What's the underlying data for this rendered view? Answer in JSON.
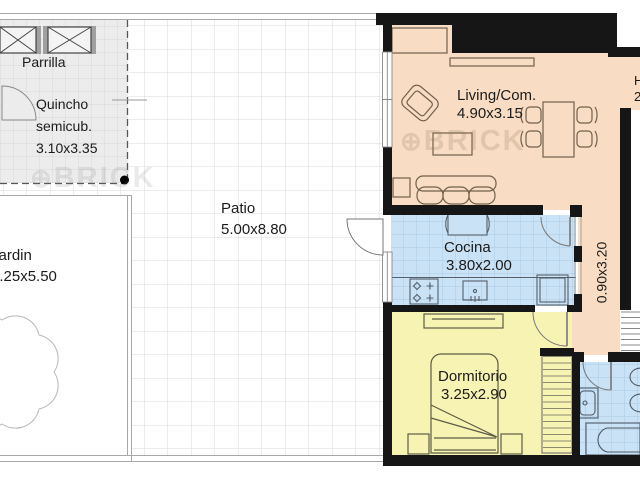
{
  "watermark": {
    "icon": "⊕",
    "text": "BRICK"
  },
  "rooms": {
    "parrilla": {
      "label": "Parrilla"
    },
    "quincho": {
      "line1": "Quincho",
      "line2": "semicub.",
      "dims": "3.10x3.35"
    },
    "patio": {
      "label": "Patio",
      "dims": "5.00x8.80"
    },
    "jardin": {
      "label": "Jardin",
      "dims": "3.25x5.50"
    },
    "living": {
      "label": "Living/Com.",
      "dims": "4.90x3.15"
    },
    "cocina": {
      "label": "Cocina",
      "dims": "3.80x2.00"
    },
    "pasillo": {
      "dims": "0.90x3.20"
    },
    "dormitorio": {
      "label": "Dormitorio",
      "dims": "3.25x2.90"
    },
    "hall": {
      "label": "H",
      "dims": "2"
    }
  },
  "colors": {
    "living": "#f8dcc3",
    "kitchen_bath": "#c9e2f5",
    "bedroom": "#f7f3b2",
    "quincho": "#ececec",
    "wall": "#161616",
    "tile_line": "#d9d9d9"
  }
}
